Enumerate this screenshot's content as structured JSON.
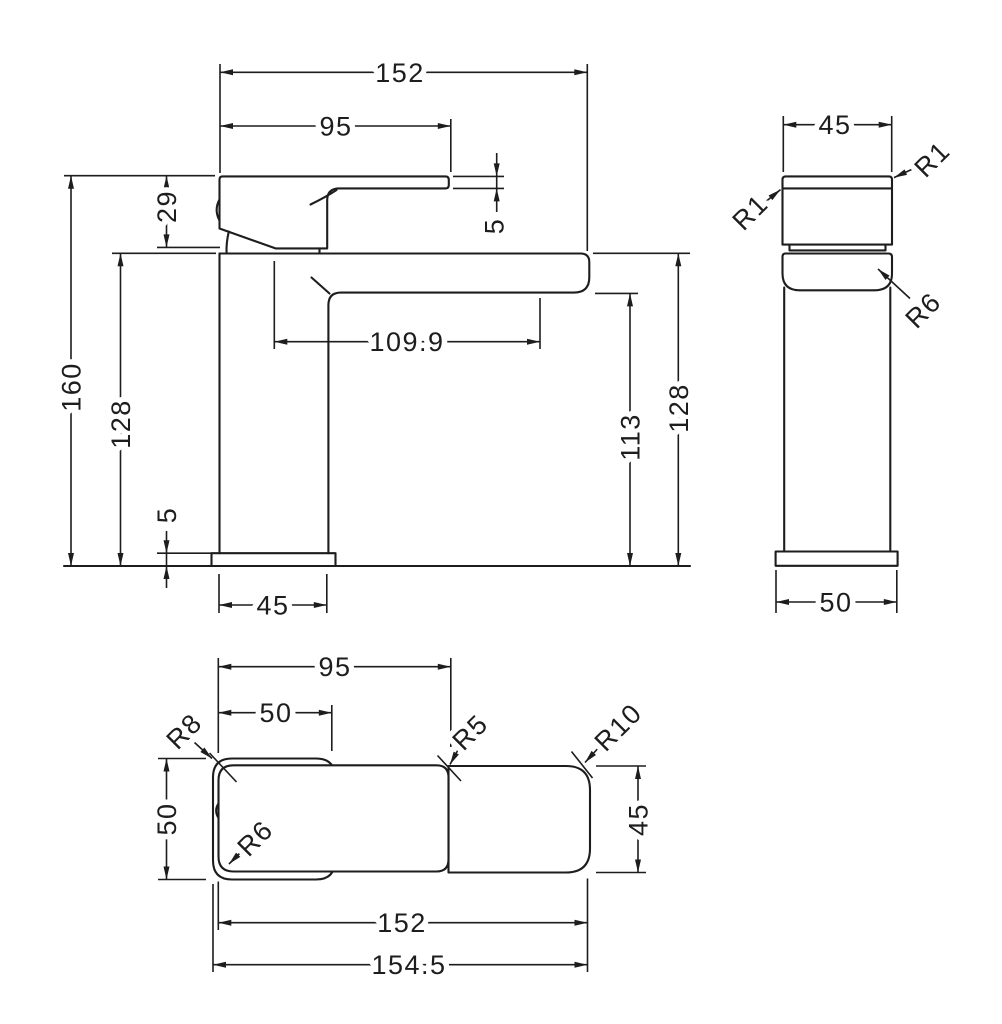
{
  "drawing": {
    "type": "technical-dimension-drawing",
    "subject": "square single-lever basin mixer tap, three orthographic views",
    "background_color": "#ffffff",
    "line_color": "#1d1d1d"
  },
  "views": {
    "front": {
      "overall_width": "152",
      "handle_length": "95",
      "lever_tip_thickness": "5",
      "body_height": "29",
      "overall_height": "160",
      "deck_height_left": "128",
      "spout_reach": "109.9",
      "spout_clearance": "113",
      "deck_height_right": "128",
      "base_thickness": "5",
      "column_width": "45"
    },
    "side": {
      "handle_depth": "45",
      "lever_radius_right": "R1",
      "lever_radius_left": "R1",
      "deck_radius": "R6",
      "base_depth": "50"
    },
    "plan": {
      "handle_length": "95",
      "grip_length": "50",
      "back_width": "50",
      "spout_width": "45",
      "body_length": "152",
      "overall_length": "154.5",
      "back_radius": "R8",
      "mid_radius": "R5",
      "spout_radius": "R10",
      "inner_radius": "R6"
    }
  }
}
